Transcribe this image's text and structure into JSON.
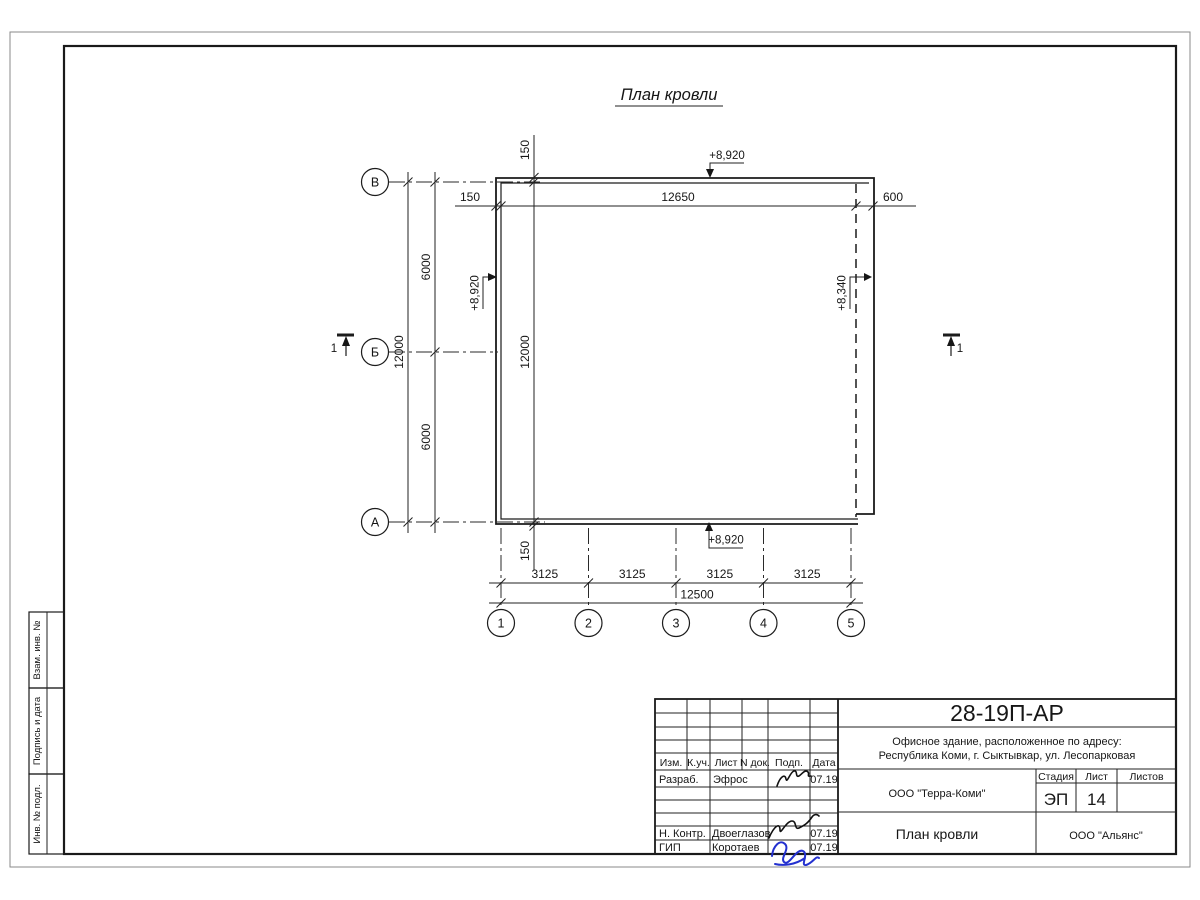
{
  "plan": {
    "title": "План кровли",
    "row_axes": [
      "В",
      "Б",
      "А"
    ],
    "col_axes": [
      "1",
      "2",
      "3",
      "4",
      "5"
    ],
    "section_mark": "1",
    "dims": {
      "overhang_top": "150",
      "top_width": "12650",
      "top_right_ext": "600",
      "inner_overhang_top": "150",
      "inner_height": "12000",
      "inner_overhang_bottom": "150",
      "span_v_top": "6000",
      "span_v_bottom": "6000",
      "total_height": "12000",
      "spans_bottom": [
        "3125",
        "3125",
        "3125",
        "3125"
      ],
      "total_width": "12500"
    },
    "elevations": {
      "top": "+8,920",
      "left": "+8,920",
      "bottom": "+8,920",
      "right": "+8,340"
    }
  },
  "titleblock": {
    "doc_number": "28-19П-АР",
    "project_line1": "Офисное здание, расположенное по адресу:",
    "project_line2": "Республика Коми, г. Сыктывкар, ул. Лесопарковая",
    "org_design": "ООО \"Терра-Коми\"",
    "org_customer": "ООО \"Альянс\"",
    "sheet_name": "План кровли",
    "stage_label": "Стадия",
    "sheet_label": "Лист",
    "sheets_label": "Листов",
    "stage_value": "ЭП",
    "sheet_value": "14",
    "sheets_value": "",
    "header": [
      "Изм.",
      "К.уч.",
      "Лист",
      "N док.",
      "Подп.",
      "Дата"
    ],
    "rows": [
      {
        "role": "Разраб.",
        "name": "Эфрос",
        "date": "07.19"
      },
      {
        "role": "Н. Контр.",
        "name": "Двоеглазов",
        "date": "07.19"
      },
      {
        "role": "ГИП",
        "name": "Коротаев",
        "date": "07.19"
      }
    ]
  },
  "side_labels": [
    "Взам. инв. №",
    "Подпись и дата",
    "Инв. № подл."
  ]
}
